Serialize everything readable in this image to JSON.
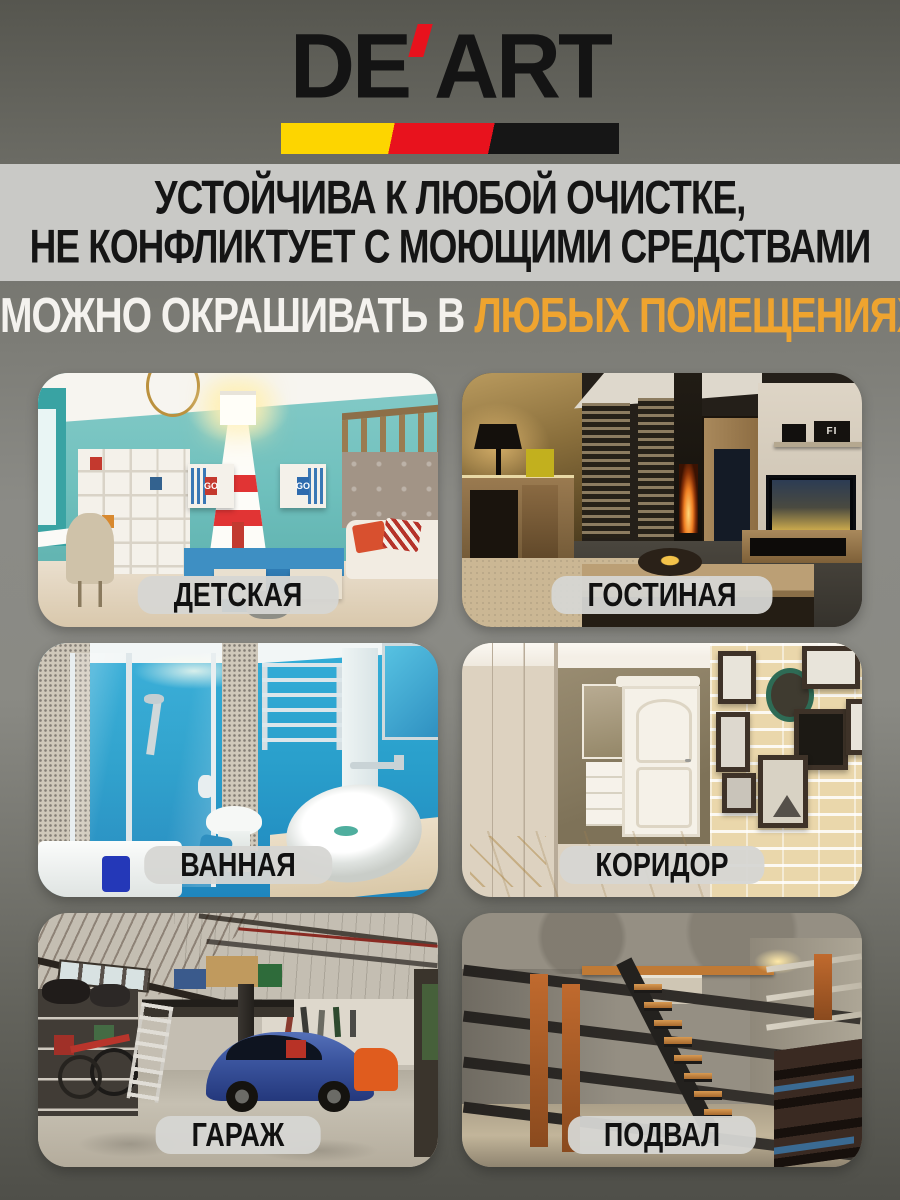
{
  "page": {
    "background_top": "#56564f",
    "background_middle": "#8b8b86",
    "background_bottom": "#4f4f49"
  },
  "brand": {
    "name": "DE'ART",
    "part1": "DE",
    "part2": "ART",
    "text_color": "#141414",
    "apostrophe_color": "#e8121d",
    "stripe_colors": [
      "#fdd500",
      "#e8121d",
      "#161616"
    ]
  },
  "claims": {
    "line1": "УСТОЙЧИВА К ЛЮБОЙ ОЧИСТКЕ,",
    "line2": "НЕ КОНФЛИКТУЕТ С МОЮЩИМИ СРЕДСТВАМИ",
    "band_background": "#c9c9c6",
    "text_color": "#151515"
  },
  "subtitle": {
    "white": "МОЖНО ОКРАШИВАТЬ В",
    "accent": "ЛЮБЫХ ПОМЕЩЕНИЯХ",
    "white_color": "#f4f2ee",
    "accent_color": "#efa42f"
  },
  "rooms": [
    {
      "label": "ДЕТСКАЯ"
    },
    {
      "label": "ГОСТИНАЯ"
    },
    {
      "label": "ВАННАЯ"
    },
    {
      "label": "КОРИДОР"
    },
    {
      "label": "ГАРАЖ"
    },
    {
      "label": "ПОДВАЛ"
    }
  ],
  "photo_texts": {
    "kids_box_left": "GO",
    "kids_box_right": "GO",
    "living_shelf": "FI"
  },
  "label_pill": {
    "background": "#d6d6d3",
    "text_color": "#111111"
  }
}
